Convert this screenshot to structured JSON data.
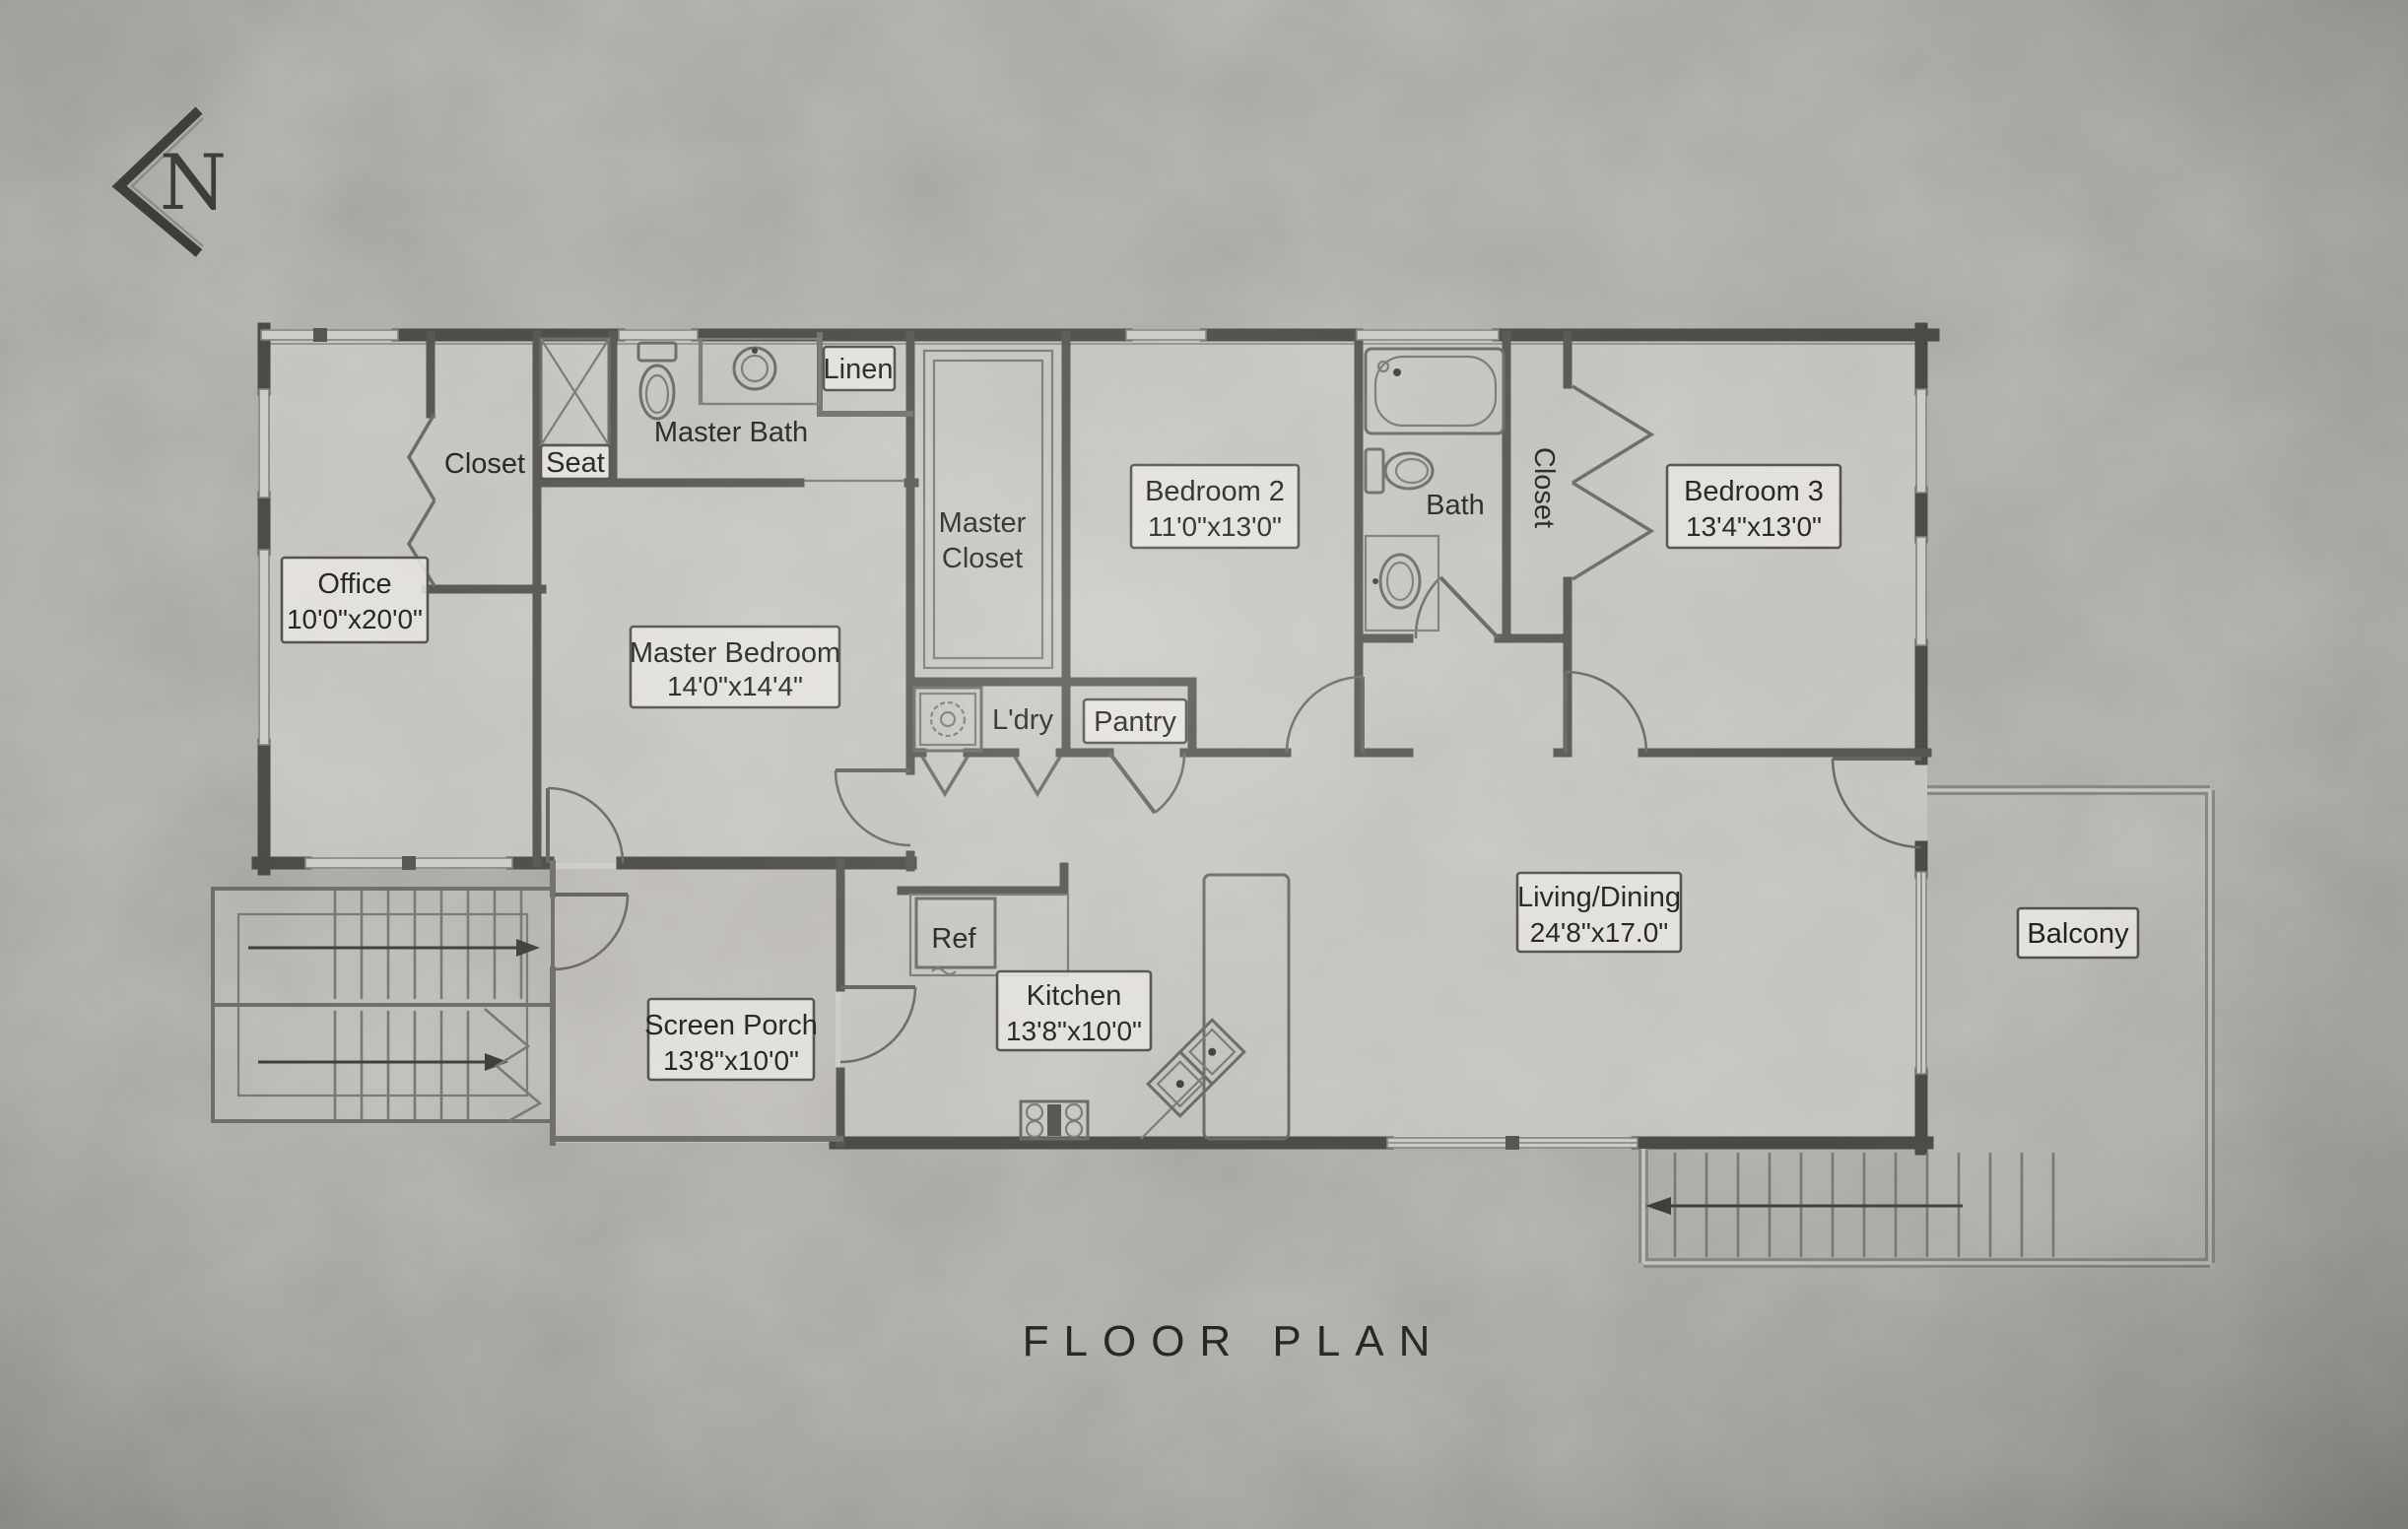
{
  "title": "FLOOR PLAN",
  "north": {
    "label": "N"
  },
  "rooms": {
    "office": {
      "label": "Office",
      "dims": "10'0\"x20'0\""
    },
    "closet_office": {
      "label": "Closet"
    },
    "seat": {
      "label": "Seat"
    },
    "master_bath": {
      "label": "Master Bath"
    },
    "linen": {
      "label": "Linen"
    },
    "master_closet": {
      "label_line1": "Master",
      "label_line2": "Closet"
    },
    "master_bedroom": {
      "label": "Master Bedroom",
      "dims": "14'0\"x14'4\""
    },
    "bedroom2": {
      "label": "Bedroom 2",
      "dims": "11'0\"x13'0\""
    },
    "bath": {
      "label": "Bath"
    },
    "closet_bed3": {
      "label": "Closet"
    },
    "bedroom3": {
      "label": "Bedroom 3",
      "dims": "13'4\"x13'0\""
    },
    "laundry": {
      "label": "L'dry"
    },
    "pantry": {
      "label": "Pantry"
    },
    "ref": {
      "label": "Ref"
    },
    "kitchen": {
      "label": "Kitchen",
      "dims": "13'8\"x10'0\""
    },
    "living_dining": {
      "label": "Living/Dining",
      "dims": "24'8\"x17.0\""
    },
    "screen_porch": {
      "label": "Screen Porch",
      "dims": "13'8\"x10'0\""
    },
    "balcony": {
      "label": "Balcony"
    }
  },
  "colors": {
    "background": "#a7a5a0",
    "wall": "#4a4946",
    "label_text": "#22211f",
    "label_box": "#e9e7e2"
  }
}
